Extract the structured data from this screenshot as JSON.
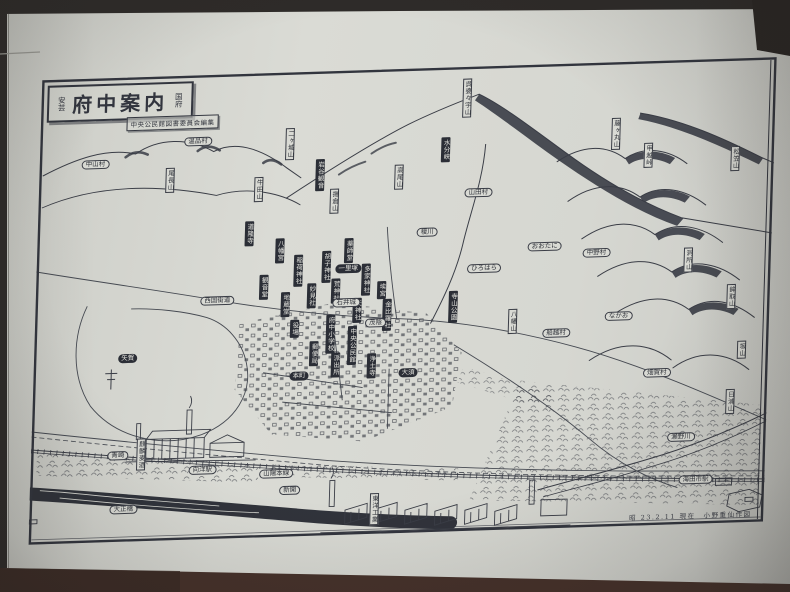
{
  "map": {
    "region_label_left": "安芸",
    "title": "府中案内",
    "region_label_right": "国府",
    "subtitle": "中央公民館図書委員会編集",
    "attribution": "昭 23.2.11 現在　小野重仙作図",
    "labels": [
      {
        "text": "呉婆々宇山",
        "type": "wv",
        "x": 426,
        "y": 12
      },
      {
        "text": "水分峡",
        "type": "bv",
        "x": 406,
        "y": 70
      },
      {
        "text": "高尾山",
        "type": "wv",
        "x": 360,
        "y": 96
      },
      {
        "text": "揚倉山",
        "type": "wv",
        "x": 296,
        "y": 118
      },
      {
        "text": "二ヶ城山",
        "type": "wv",
        "x": 250,
        "y": 56
      },
      {
        "text": "尾長山",
        "type": "wv",
        "x": 131,
        "y": 92
      },
      {
        "text": "牛田山",
        "type": "wv",
        "x": 220,
        "y": 104
      },
      {
        "text": "藤ヶ丸山",
        "type": "wv",
        "x": 576,
        "y": 56
      },
      {
        "text": "甲越峠",
        "type": "wv",
        "x": 609,
        "y": 82
      },
      {
        "text": "松笠山",
        "type": "wv",
        "x": 696,
        "y": 88
      },
      {
        "text": "洞所山",
        "type": "wv",
        "x": 652,
        "y": 188
      },
      {
        "text": "鉾取山",
        "type": "wv",
        "x": 696,
        "y": 226
      },
      {
        "text": "坂山",
        "type": "wv",
        "x": 708,
        "y": 283
      },
      {
        "text": "日浦山",
        "type": "wv",
        "x": 698,
        "y": 331
      },
      {
        "text": "八幡山",
        "type": "wv",
        "x": 478,
        "y": 244
      },
      {
        "text": "東洋工業",
        "type": "wv",
        "x": 345,
        "y": 424
      },
      {
        "text": "麒麟麦酒",
        "type": "wv",
        "x": 110,
        "y": 362
      },
      {
        "text": "岩谷観音",
        "type": "bv",
        "x": 281,
        "y": 88
      },
      {
        "text": "道隆寺",
        "type": "bv",
        "x": 212,
        "y": 148
      },
      {
        "text": "八幡宮",
        "type": "bv",
        "x": 243,
        "y": 166
      },
      {
        "text": "薬師堂",
        "type": "bv",
        "x": 312,
        "y": 168
      },
      {
        "text": "稲荷神社",
        "type": "bv",
        "x": 262,
        "y": 183
      },
      {
        "text": "胡子神社",
        "type": "bv",
        "x": 290,
        "y": 180
      },
      {
        "text": "多家神社",
        "type": "bv",
        "x": 330,
        "y": 194
      },
      {
        "text": "埃宮",
        "type": "bv",
        "x": 346,
        "y": 212
      },
      {
        "text": "観音堂",
        "type": "bv",
        "x": 228,
        "y": 202
      },
      {
        "text": "地蔵堂",
        "type": "bv",
        "x": 250,
        "y": 220
      },
      {
        "text": "妙見社",
        "type": "bv",
        "x": 276,
        "y": 212
      },
      {
        "text": "荒神社",
        "type": "bv",
        "x": 300,
        "y": 208
      },
      {
        "text": "天神社",
        "type": "bv",
        "x": 322,
        "y": 228
      },
      {
        "text": "金比羅社",
        "type": "bv",
        "x": 352,
        "y": 230
      },
      {
        "text": "府中小学校",
        "type": "bv",
        "x": 296,
        "y": 244
      },
      {
        "text": "中央公民館",
        "type": "bv",
        "x": 318,
        "y": 256
      },
      {
        "text": "役場",
        "type": "bv",
        "x": 260,
        "y": 248
      },
      {
        "text": "郵便局",
        "type": "bv",
        "x": 280,
        "y": 270
      },
      {
        "text": "派出所",
        "type": "bv",
        "x": 302,
        "y": 282
      },
      {
        "text": "浄土寺",
        "type": "bv",
        "x": 338,
        "y": 284
      },
      {
        "text": "寺山公園",
        "type": "bv",
        "x": 418,
        "y": 224
      },
      {
        "text": "一里塚",
        "type": "bp",
        "x": 312,
        "y": 194
      },
      {
        "text": "矢賀",
        "type": "bp",
        "x": 94,
        "y": 277
      },
      {
        "text": "本町",
        "type": "bp",
        "x": 266,
        "y": 300
      },
      {
        "text": "大須",
        "type": "bp",
        "x": 375,
        "y": 300
      },
      {
        "text": "温品村",
        "type": "pill",
        "x": 158,
        "y": 62
      },
      {
        "text": "中山村",
        "type": "pill",
        "x": 56,
        "y": 82
      },
      {
        "text": "山田村",
        "type": "pill",
        "x": 440,
        "y": 122
      },
      {
        "text": "中野村",
        "type": "pill",
        "x": 560,
        "y": 186
      },
      {
        "text": "畑賀村",
        "type": "pill",
        "x": 624,
        "y": 308
      },
      {
        "text": "船越村",
        "type": "pill",
        "x": 522,
        "y": 265
      },
      {
        "text": "ひろはら",
        "type": "pill",
        "x": 448,
        "y": 198
      },
      {
        "text": "おおたに",
        "type": "pill",
        "x": 508,
        "y": 178
      },
      {
        "text": "なかお",
        "type": "pill",
        "x": 584,
        "y": 250
      },
      {
        "text": "榎川",
        "type": "pill",
        "x": 390,
        "y": 160
      },
      {
        "text": "西国街道",
        "type": "pill",
        "x": 182,
        "y": 222
      },
      {
        "text": "石井城",
        "type": "pill",
        "x": 311,
        "y": 228
      },
      {
        "text": "茂陰",
        "type": "pill",
        "x": 341,
        "y": 249
      },
      {
        "text": "瀬野川",
        "type": "pill",
        "x": 650,
        "y": 373
      },
      {
        "text": "海田市駅",
        "type": "pill",
        "x": 666,
        "y": 416
      },
      {
        "text": "向洋駅",
        "type": "pill",
        "x": 172,
        "y": 391
      },
      {
        "text": "青崎",
        "type": "pill",
        "x": 87,
        "y": 374
      },
      {
        "text": "新開",
        "type": "pill",
        "x": 260,
        "y": 414
      },
      {
        "text": "山陽本線",
        "type": "pill",
        "x": 246,
        "y": 397
      },
      {
        "text": "大正橋",
        "type": "pill",
        "x": 94,
        "y": 428
      }
    ]
  },
  "colors": {
    "paper": "#d6d7d1",
    "ink": "#3a3d46",
    "label_black": "#2b2e36",
    "photo_top_band": "#2e2b29",
    "photo_bottom_band": "#4a332b"
  }
}
